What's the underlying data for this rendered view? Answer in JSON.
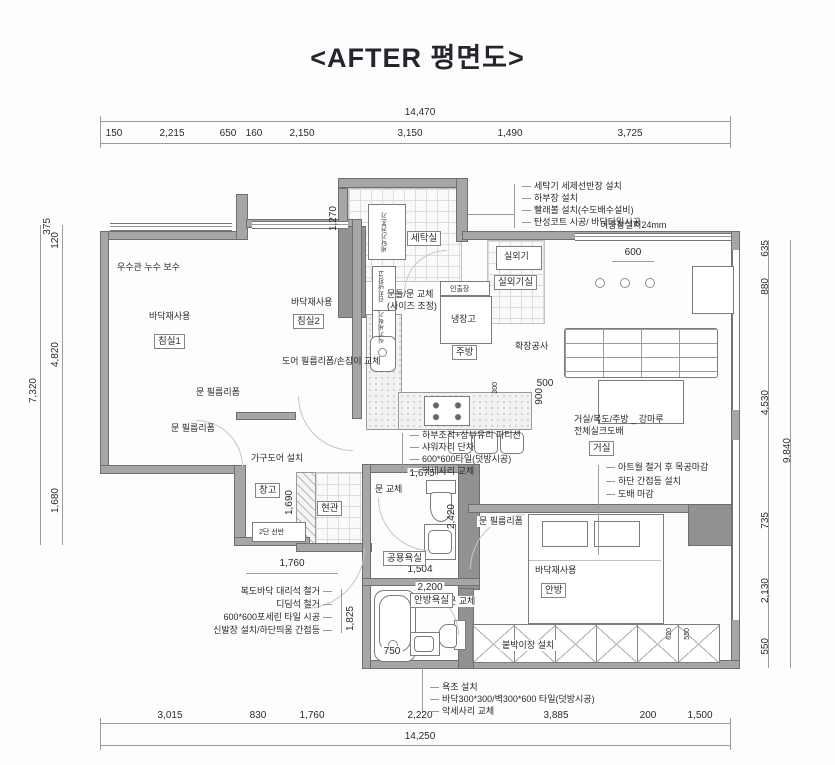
{
  "title": "<AFTER 평면도>",
  "dimensions": {
    "top": {
      "total": "14,470",
      "segments": [
        "150",
        "2,215",
        "650",
        "160",
        "2,150",
        "3,150",
        "1,490",
        "3,725"
      ]
    },
    "bottom": {
      "total": "14,250",
      "segments": [
        "3,015",
        "830",
        "1,760",
        "2,220",
        "3,885",
        "200",
        "1,500"
      ]
    },
    "left": {
      "total": "7,320",
      "segments": [
        "375",
        "120",
        "4,820",
        "1,680"
      ]
    },
    "right": {
      "total": "9,840",
      "segments": [
        "635",
        "880",
        "4,530",
        "735",
        "2,130",
        "550"
      ]
    },
    "interior": {
      "laundry_height": "1,270",
      "light_span": "600",
      "counter_width": "500",
      "counter_depth": "900",
      "island_depth": "300",
      "bath_common_width": "1,675",
      "bath_common_depth": "2,420",
      "bath_common_inner": "1,504",
      "bath_span": "2,200",
      "storage_height": "1,690",
      "hall_width": "1,760",
      "bath_master_height": "1,825",
      "tub_width": "750",
      "closet_a": "620",
      "closet_b": "550"
    }
  },
  "rooms": {
    "bedroom1": "침실1",
    "bedroom2": "침실2",
    "laundry": "세탁실",
    "outdoor_unit_room": "실외기실",
    "kitchen": "주방",
    "living": "거실",
    "entrance": "현관",
    "storage": "창고",
    "bath_common": "공용욕실",
    "bath_master": "안방욕실",
    "master_bedroom": "안방"
  },
  "fixtures": {
    "washer_dryer": "세탁기/건조기",
    "outdoor_unit": "실외기",
    "fridge": "냉장고",
    "pullout_cabinet": "인출장",
    "kimchi_fridge": "김치냉장고",
    "dishwasher": "식기세척기",
    "shelf_2tier": "2단 선반",
    "built_in_closet": "붙박이장 설치",
    "floor_material": "바닥재사용",
    "expansion": "확장공사"
  },
  "annotations": {
    "laundry_list": [
      "세탁기 세제선반장 설치",
      "하부장 설치",
      "빨래볼 설치(수도배수설비)",
      "탄성코트 시공/ 바닥타일시공"
    ],
    "double_window": "이중창설치24mm",
    "rain_pipe": "우수관 누수 보수",
    "door_reform": "도어 필름리폼/손잡이 교체",
    "door_film": "문 필름리폼",
    "furniture_door": "가구도어 설치",
    "door_replace": "문 교체",
    "door_frame_1": "문틀/문 교체",
    "door_frame_2": "(사이즈 조정)",
    "bath_list": [
      "하부조적+상부유리 파티션",
      "샤워자리 단차",
      "600*600타일(덧방시공)",
      "악세사리 교체"
    ],
    "living_floor": "거실/복도/주방 _ 강마루",
    "living_wallpaper": "전체실크도배",
    "living_list": [
      "아트월 철거 후 목공마감",
      "하단 간접등 설치",
      "도배 마감"
    ],
    "hall_list": [
      "복도바닥 대리석 철거",
      "디딤석 철거",
      "600*600포세린 타일 시공",
      "신발장 설치/하단띄움 간접등"
    ],
    "tub_list": [
      "욕조 설치",
      "바닥300*300/벽300*600 타일(덧방시공)",
      "악세사리 교체"
    ]
  }
}
